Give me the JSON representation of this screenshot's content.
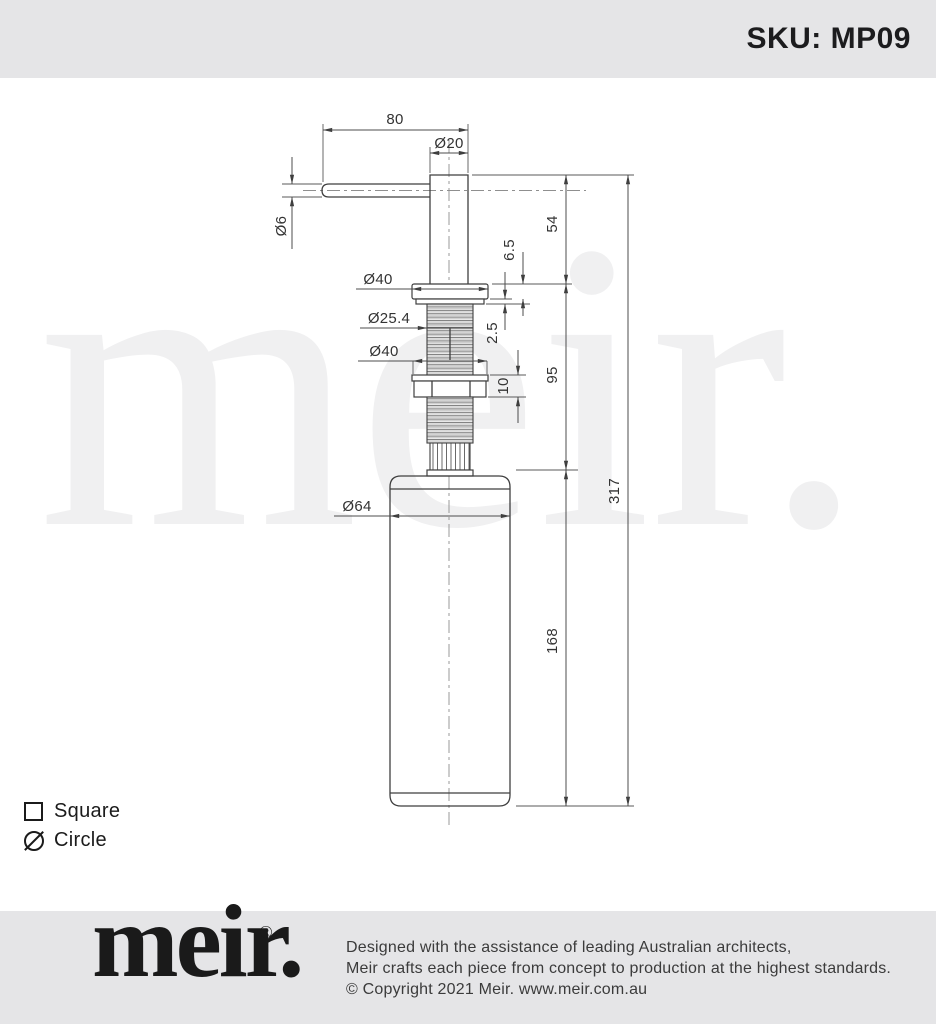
{
  "header": {
    "sku": "SKU: MP09"
  },
  "watermark": "meir.",
  "drawing": {
    "dimensions": {
      "spout_length": "80",
      "spout_diameter": "Ø20",
      "spout_tube_diameter": "Ø6",
      "flange_diameter": "Ø40",
      "thread_diameter": "Ø25.4",
      "nut_diameter": "Ø40",
      "flange_height": "6.5",
      "washer_thickness": "2.5",
      "nut_height": "10",
      "above_bench_height": "54",
      "below_bench_depth": "95",
      "bottle_height": "168",
      "total_height": "317",
      "bottle_diameter": "Ø64"
    }
  },
  "legend": {
    "square": "Square",
    "circle": "Circle"
  },
  "footer": {
    "logo": "meir.",
    "registered": "®",
    "lines": [
      "Designed with the assistance of leading Australian architects,",
      "Meir crafts each piece from concept to production at the highest standards.",
      "© Copyright 2021 Meir. www.meir.com.au"
    ]
  },
  "colors": {
    "bar": "#e5e5e7",
    "line": "#3f3f3f",
    "watermark": "#f0f0f1"
  }
}
